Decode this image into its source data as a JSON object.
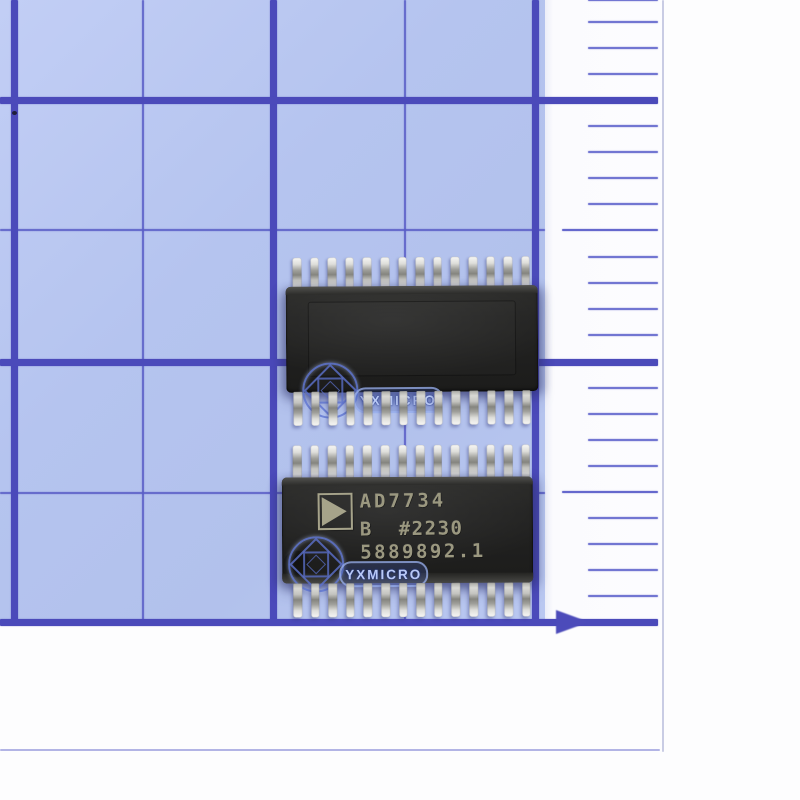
{
  "paper": {
    "bg_color": "#b5c4ef",
    "major_line_color": "#4b4aba",
    "minor_line_color": "#5a5ec7",
    "major_vertical_x": [
      14,
      273,
      535
    ],
    "minor_vertical_x": [
      143,
      405
    ],
    "major_horizontal_y": [
      100,
      362,
      622
    ],
    "minor_horizontal_y": [
      230,
      493
    ]
  },
  "ruler": {
    "bg_color": "#fbfbfe",
    "tick_color": "#7276d2",
    "mid_tick_color": "#6568cd",
    "minor_tick_y": [
      0,
      22,
      48,
      74,
      126,
      152,
      178,
      204,
      257,
      283,
      309,
      335,
      388,
      414,
      440,
      466,
      518,
      544,
      570,
      596
    ],
    "mid_tick_y": [
      230,
      492
    ],
    "arrow_y": 622,
    "edge_line_x": 662,
    "bottom_line_y": 750
  },
  "chips": {
    "top": {
      "pins_per_side": 14,
      "side": "back-side-up",
      "body_color": "#232322"
    },
    "bottom": {
      "pins_per_side": 14,
      "side": "marked-side-up",
      "body_color": "#232322",
      "marking_color": "#9b9880",
      "logo": "analog-devices-triangle",
      "marking_line1": "AD7734",
      "marking_line2": "B  #2230",
      "marking_line3": "5889892.1"
    }
  },
  "watermark": {
    "text": "YXMICRO",
    "color": "#5063c8"
  },
  "pin_color": "#d8d8d4"
}
